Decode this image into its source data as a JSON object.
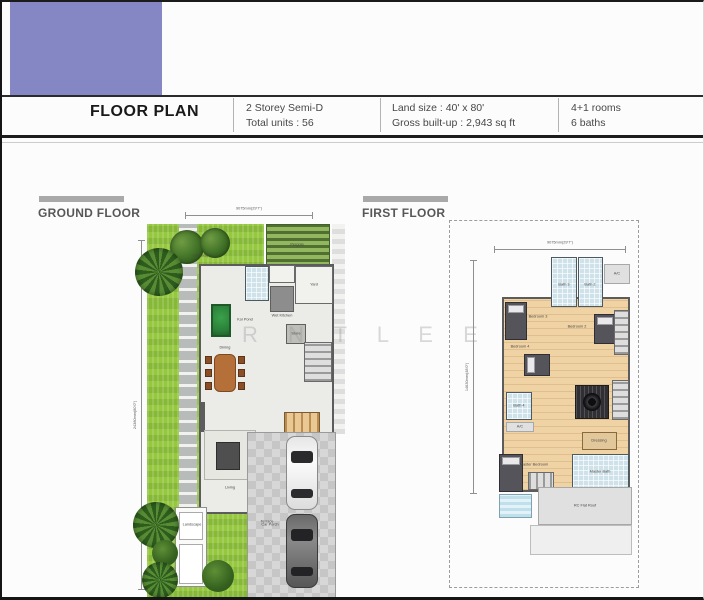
{
  "page": {
    "accent_color": "#8487c3",
    "background": "#fcfcfc"
  },
  "header": {
    "title": "FLOOR PLAN",
    "info_columns": [
      {
        "line1": "2 Storey Semi-D",
        "line2": "Total units : 56"
      },
      {
        "line1": "Land size : 40' x 80'",
        "line2": "Gross built-up : 2,943 sq ft"
      },
      {
        "line1": "4+1 rooms",
        "line2": "6 baths"
      }
    ]
  },
  "watermark": "R N T  L E E",
  "plans": {
    "ground": {
      "title": "GROUND FLOOR",
      "dim_top": "9075mm(29'7\")",
      "dim_left": "24380mm(80'0\")",
      "labels": {
        "pergola": "Pergola",
        "landscape_top": "Landscape",
        "yard": "Yard",
        "wet_kitchen": "Wet Kitchen",
        "koi_pond": "Koi Pond",
        "store": "Store",
        "dining": "Dining",
        "living": "Living",
        "terrace": "Terrace",
        "car_porch": "Car Porch",
        "landscape_bottom": "Landscape"
      }
    },
    "first": {
      "title": "FIRST FLOOR",
      "dim_top": "9075mm(29'7\")",
      "dim_left": "14630mm(48'0\")",
      "labels": {
        "ac_top": "A/C",
        "bath3": "Bath 3",
        "bath2": "Bath 2",
        "bedroom3": "Bedroom 3",
        "bedroom2": "Bedroom 2",
        "bedroom4": "Bedroom 4",
        "bath4": "Bath 4",
        "ac_mid": "A/C",
        "dressing": "Dressing",
        "master_bedroom": "Master Bedroom",
        "master_bath": "Master Bath",
        "rc_flat_roof": "RC Flat Roof"
      }
    }
  }
}
